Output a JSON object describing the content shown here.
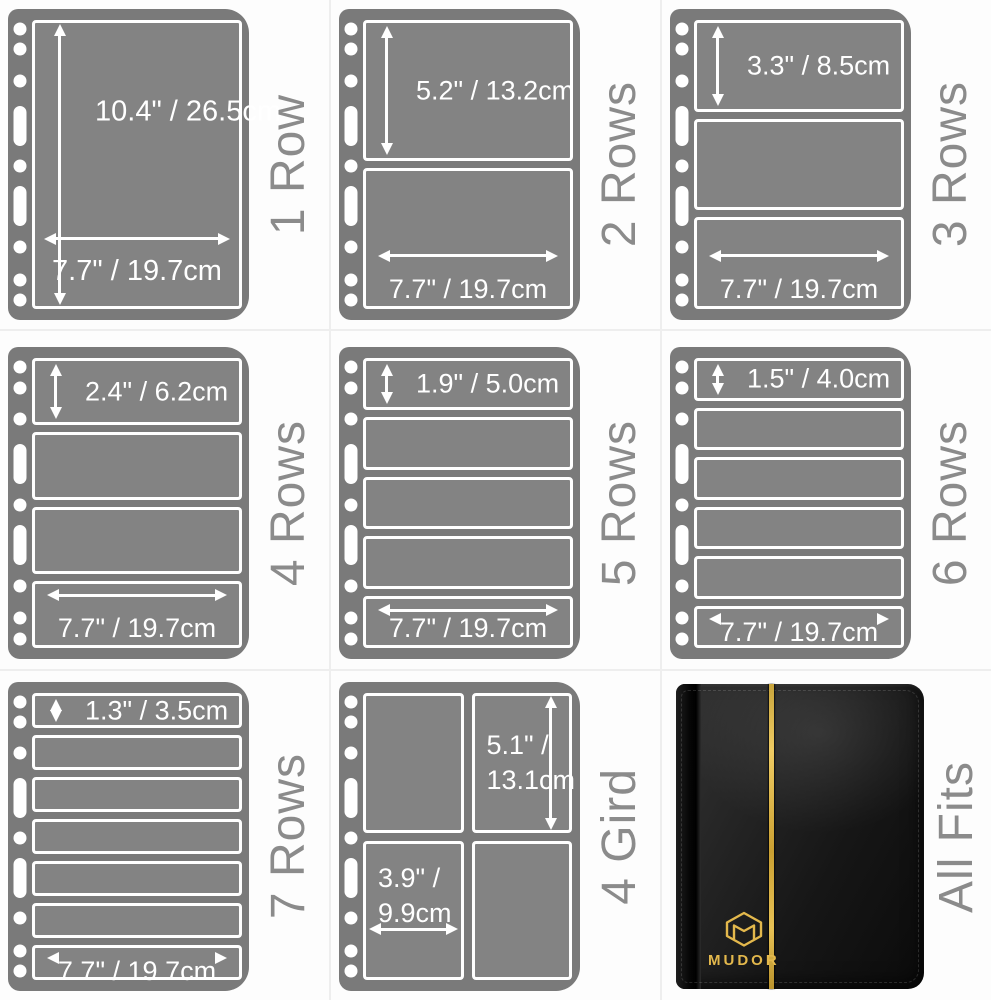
{
  "collage_title": "MUDOR stamp album pocket page configurations",
  "colors": {
    "sheet_gray": "#7a7a7a",
    "pocket_gray": "#838383",
    "pocket_border": "#ffffff",
    "dimension_text": "#ffffff",
    "side_label_gray": "#8b8b8b",
    "binder_black": "#161616",
    "gold_accent": "#e3b84c",
    "background": "#fdfdfd"
  },
  "hole_pattern": [
    "circle",
    "circle",
    "circle",
    "oval",
    "circle",
    "oval",
    "circle",
    "circle",
    "circle"
  ],
  "panels": [
    {
      "label": "1 Row",
      "height_label": "10.4\" / 26.5cm",
      "width_label": "7.7\" / 19.7cm"
    },
    {
      "label": "2 Rows",
      "height_label": "5.2\" / 13.2cm",
      "width_label": "7.7\" / 19.7cm"
    },
    {
      "label": "3 Rows",
      "height_label": "3.3\" / 8.5cm",
      "width_label": "7.7\" / 19.7cm"
    },
    {
      "label": "4 Rows",
      "height_label": "2.4\" / 6.2cm",
      "width_label": "7.7\" / 19.7cm"
    },
    {
      "label": "5 Rows",
      "height_label": "1.9\" / 5.0cm",
      "width_label": "7.7\" / 19.7cm"
    },
    {
      "label": "6 Rows",
      "height_label": "1.5\" / 4.0cm",
      "width_label": "7.7\" / 19.7cm"
    },
    {
      "label": "7 Rows",
      "height_label": "1.3\" / 3.5cm",
      "width_label": "7.7\" / 19.7cm"
    },
    {
      "label": "4 Gird",
      "height_line1": "5.1\" /",
      "height_line2": "13.1cm",
      "width_line1": "3.9\" /",
      "width_line2": "9.9cm"
    },
    {
      "label": "All Fits",
      "brand": "MUDOR"
    }
  ]
}
